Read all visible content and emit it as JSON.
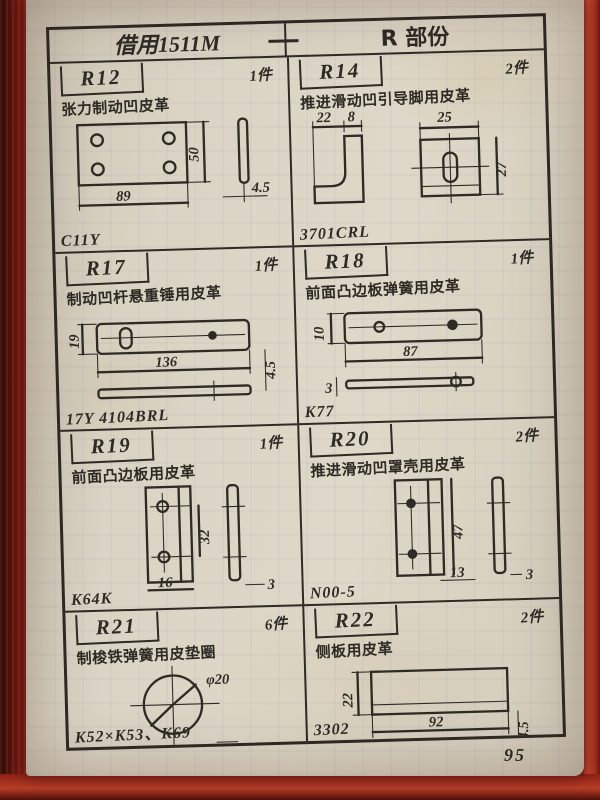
{
  "header": {
    "left": "借用1511M",
    "dash": "—",
    "right": "R 部份"
  },
  "page_number": "95",
  "colors": {
    "ink": "#2e2b25",
    "paper": "#d9d3c3",
    "cover_red": "#8a2014",
    "edge_red": "#c0452e"
  },
  "parts": [
    {
      "id": "R12",
      "qty": "1件",
      "desc": "张力制动凹皮革",
      "code": "C11Y",
      "dims": {
        "length": "89",
        "height": "50",
        "thickness": "4.5"
      }
    },
    {
      "id": "R14",
      "qty": "2件",
      "desc": "推进滑动凹引导脚用皮革",
      "code": "3701CRL",
      "dims": {
        "d1": "22",
        "d2": "8",
        "d3": "25",
        "d4": "27"
      }
    },
    {
      "id": "R17",
      "qty": "1件",
      "desc": "制动凹杆悬重锤用皮革",
      "code": "17Y 4104BRL",
      "dims": {
        "height": "19",
        "length": "136",
        "thickness": "4.5"
      }
    },
    {
      "id": "R18",
      "qty": "1件",
      "desc": "前面凸边板弹簧用皮革",
      "code": "K77",
      "dims": {
        "height": "10",
        "length": "87",
        "thickness": "3"
      }
    },
    {
      "id": "R19",
      "qty": "1件",
      "desc": "前面凸边板用皮革",
      "code": "K64K",
      "dims": {
        "height": "32",
        "width": "16",
        "thickness": "3"
      }
    },
    {
      "id": "R20",
      "qty": "2件",
      "desc": "推进滑动凹罩壳用皮革",
      "code": "N00-5",
      "dims": {
        "height": "47",
        "width": "13",
        "thickness": "3"
      }
    },
    {
      "id": "R21",
      "qty": "6件",
      "desc": "制梭铁弹簧用皮垫圈",
      "code": "K52×K53、K69",
      "dims": {
        "diameter": "φ20",
        "thickness": "5"
      }
    },
    {
      "id": "R22",
      "qty": "2件",
      "desc": "侧板用皮革",
      "code": "3302",
      "dims": {
        "height": "22",
        "length": "92",
        "thickness": "4.5"
      }
    }
  ]
}
